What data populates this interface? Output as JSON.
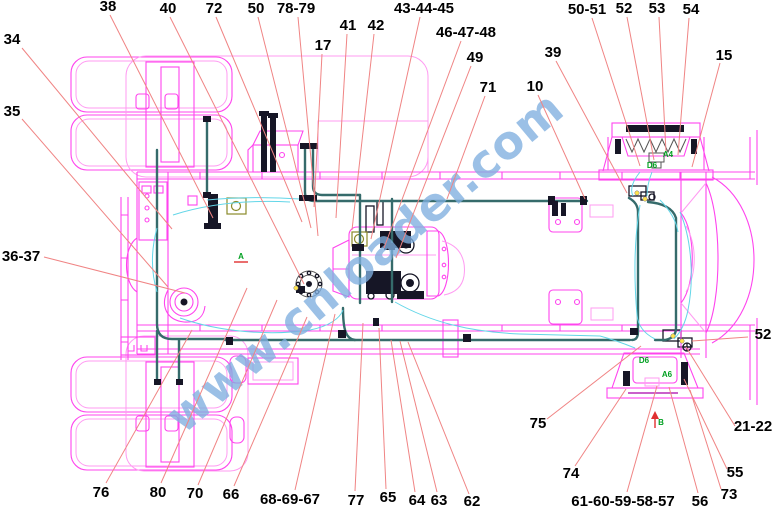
{
  "diagram": {
    "watermark": "www.cnloader.com",
    "colors": {
      "pink": "#ff44ee",
      "pink_light": "#ff9bf2",
      "purple": "#aa00aa",
      "leader": "#f08484",
      "watermark": "#7fafdf",
      "teal": "#356b6b",
      "cyan": "#63d6e8",
      "green": "#00a020",
      "yellow": "#ffe34d",
      "dark": "#161626",
      "olive": "#8a8a2a",
      "red": "#e03030",
      "ink": "#000000"
    },
    "part_labels": [
      {
        "t": "38",
        "x": 108,
        "y": 11,
        "x1": 110,
        "y1": 15,
        "x2": 213,
        "y2": 218
      },
      {
        "t": "40",
        "x": 168,
        "y": 13,
        "x1": 170,
        "y1": 17,
        "x2": 304,
        "y2": 284
      },
      {
        "t": "72",
        "x": 214,
        "y": 13,
        "x1": 216,
        "y1": 17,
        "x2": 302,
        "y2": 222
      },
      {
        "t": "50",
        "x": 256,
        "y": 13,
        "x1": 258,
        "y1": 17,
        "x2": 311,
        "y2": 228
      },
      {
        "t": "78-79",
        "x": 296,
        "y": 13,
        "x1": 298,
        "y1": 17,
        "x2": 318,
        "y2": 236
      },
      {
        "t": "17",
        "x": 323,
        "y": 50,
        "x1": 322,
        "y1": 54,
        "x2": 314,
        "y2": 207
      },
      {
        "t": "41",
        "x": 348,
        "y": 30,
        "x1": 347,
        "y1": 34,
        "x2": 336,
        "y2": 218
      },
      {
        "t": "42",
        "x": 376,
        "y": 30,
        "x1": 374,
        "y1": 34,
        "x2": 352,
        "y2": 230
      },
      {
        "t": "43-44-45",
        "x": 424,
        "y": 13,
        "x1": 420,
        "y1": 17,
        "x2": 371,
        "y2": 239
      },
      {
        "t": "46-47-48",
        "x": 466,
        "y": 37,
        "x1": 461,
        "y1": 41,
        "x2": 384,
        "y2": 248
      },
      {
        "t": "49",
        "x": 475,
        "y": 62,
        "x1": 471,
        "y1": 66,
        "x2": 396,
        "y2": 258
      },
      {
        "t": "71",
        "x": 488,
        "y": 92,
        "x1": 485,
        "y1": 96,
        "x2": 447,
        "y2": 199
      },
      {
        "t": "10",
        "x": 535,
        "y": 91,
        "x1": 538,
        "y1": 95,
        "x2": 585,
        "y2": 199
      },
      {
        "t": "39",
        "x": 553,
        "y": 57,
        "x1": 556,
        "y1": 61,
        "x2": 627,
        "y2": 193
      },
      {
        "t": "50-51",
        "x": 587,
        "y": 14,
        "x1": 592,
        "y1": 18,
        "x2": 640,
        "y2": 166
      },
      {
        "t": "52",
        "x": 624,
        "y": 13,
        "x1": 627,
        "y1": 17,
        "x2": 654,
        "y2": 160
      },
      {
        "t": "53",
        "x": 657,
        "y": 13,
        "x1": 659,
        "y1": 17,
        "x2": 666,
        "y2": 152
      },
      {
        "t": "54",
        "x": 691,
        "y": 14,
        "x1": 689,
        "y1": 18,
        "x2": 678,
        "y2": 155
      },
      {
        "t": "15",
        "x": 724,
        "y": 60,
        "x1": 720,
        "y1": 63,
        "x2": 692,
        "y2": 167
      },
      {
        "t": "34",
        "x": 12,
        "y": 44,
        "x1": 22,
        "y1": 48,
        "x2": 172,
        "y2": 229
      },
      {
        "t": "35",
        "x": 12,
        "y": 116,
        "x1": 22,
        "y1": 119,
        "x2": 168,
        "y2": 287
      },
      {
        "t": "36-37",
        "x": 21,
        "y": 261,
        "x1": 44,
        "y1": 257,
        "x2": 185,
        "y2": 293
      },
      {
        "t": "52",
        "x": 763,
        "y": 339,
        "x1": 748,
        "y1": 337,
        "x2": 692,
        "y2": 341
      },
      {
        "t": "21-22",
        "x": 753,
        "y": 431,
        "x1": 735,
        "y1": 426,
        "x2": 686,
        "y2": 347
      },
      {
        "t": "55",
        "x": 735,
        "y": 477,
        "x1": 727,
        "y1": 469,
        "x2": 684,
        "y2": 379
      },
      {
        "t": "73",
        "x": 729,
        "y": 499,
        "x1": 721,
        "y1": 489,
        "x2": 690,
        "y2": 390
      },
      {
        "t": "56",
        "x": 700,
        "y": 506,
        "x1": 698,
        "y1": 493,
        "x2": 669,
        "y2": 387
      },
      {
        "t": "61-60-59-58-57",
        "x": 623,
        "y": 506,
        "x1": 627,
        "y1": 492,
        "x2": 657,
        "y2": 386
      },
      {
        "t": "74",
        "x": 571,
        "y": 478,
        "x1": 575,
        "y1": 466,
        "x2": 626,
        "y2": 389
      },
      {
        "t": "75",
        "x": 538,
        "y": 428,
        "x1": 547,
        "y1": 419,
        "x2": 641,
        "y2": 346
      },
      {
        "t": "62",
        "x": 472,
        "y": 506,
        "x1": 469,
        "y1": 494,
        "x2": 408,
        "y2": 342
      },
      {
        "t": "63",
        "x": 439,
        "y": 505,
        "x1": 437,
        "y1": 492,
        "x2": 400,
        "y2": 341
      },
      {
        "t": "64",
        "x": 417,
        "y": 505,
        "x1": 415,
        "y1": 492,
        "x2": 391,
        "y2": 340
      },
      {
        "t": "65",
        "x": 388,
        "y": 502,
        "x1": 386,
        "y1": 489,
        "x2": 379,
        "y2": 328
      },
      {
        "t": "77",
        "x": 356,
        "y": 505,
        "x1": 355,
        "y1": 491,
        "x2": 363,
        "y2": 323
      },
      {
        "t": "68-69-67",
        "x": 290,
        "y": 504,
        "x1": 295,
        "y1": 490,
        "x2": 335,
        "y2": 314
      },
      {
        "t": "66",
        "x": 231,
        "y": 499,
        "x1": 234,
        "y1": 486,
        "x2": 307,
        "y2": 317
      },
      {
        "t": "70",
        "x": 195,
        "y": 498,
        "x1": 198,
        "y1": 485,
        "x2": 277,
        "y2": 300
      },
      {
        "t": "80",
        "x": 158,
        "y": 497,
        "x1": 161,
        "y1": 483,
        "x2": 247,
        "y2": 288
      },
      {
        "t": "76",
        "x": 101,
        "y": 497,
        "x1": 106,
        "y1": 483,
        "x2": 192,
        "y2": 330
      }
    ],
    "section_markers": [
      {
        "t": "A",
        "x": 241,
        "y": 259,
        "underline": true
      },
      {
        "t": "A4",
        "x": 668,
        "y": 157
      },
      {
        "t": "D6",
        "x": 652,
        "y": 168
      },
      {
        "t": "D6",
        "x": 644,
        "y": 363
      },
      {
        "t": "A6",
        "x": 667,
        "y": 377
      },
      {
        "t": "B",
        "x": 661,
        "y": 425,
        "arrow": true
      }
    ]
  }
}
